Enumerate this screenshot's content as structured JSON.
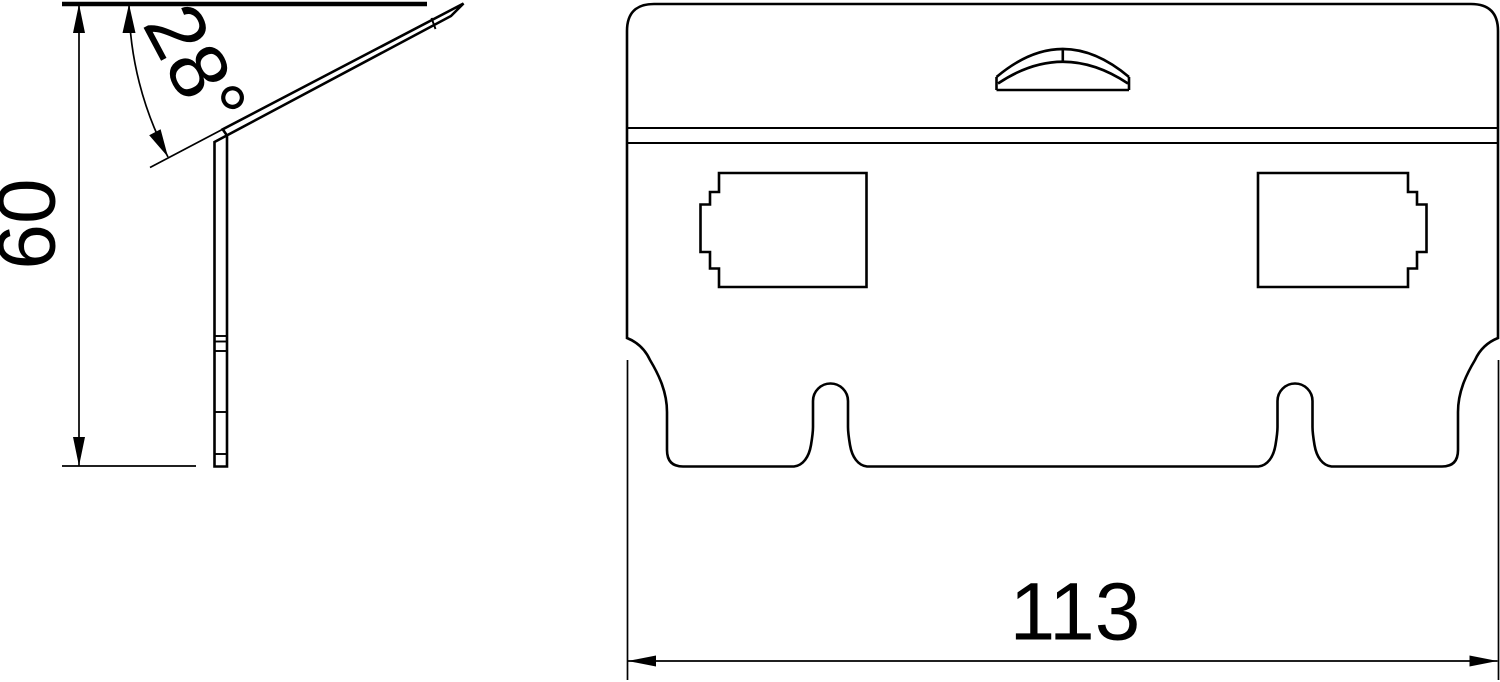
{
  "drawing": {
    "kind": "technical-drawing",
    "background_color": "#ffffff",
    "line_color": "#000000",
    "views": {
      "side_view": {
        "label": "side-profile-view",
        "angle_dimension": "28°",
        "height_dimension": "60",
        "features": [
          "bent-bracket-profile",
          "angle-arc",
          "height-dimension-line"
        ]
      },
      "front_view": {
        "label": "front-view",
        "width_dimension": "113",
        "features": [
          "rounded-top-plate",
          "fold-line-double",
          "hanger-tab",
          "port-cutout-left",
          "port-cutout-right",
          "keyhole-slot-left",
          "keyhole-slot-right",
          "width-dimension-line"
        ]
      }
    }
  }
}
